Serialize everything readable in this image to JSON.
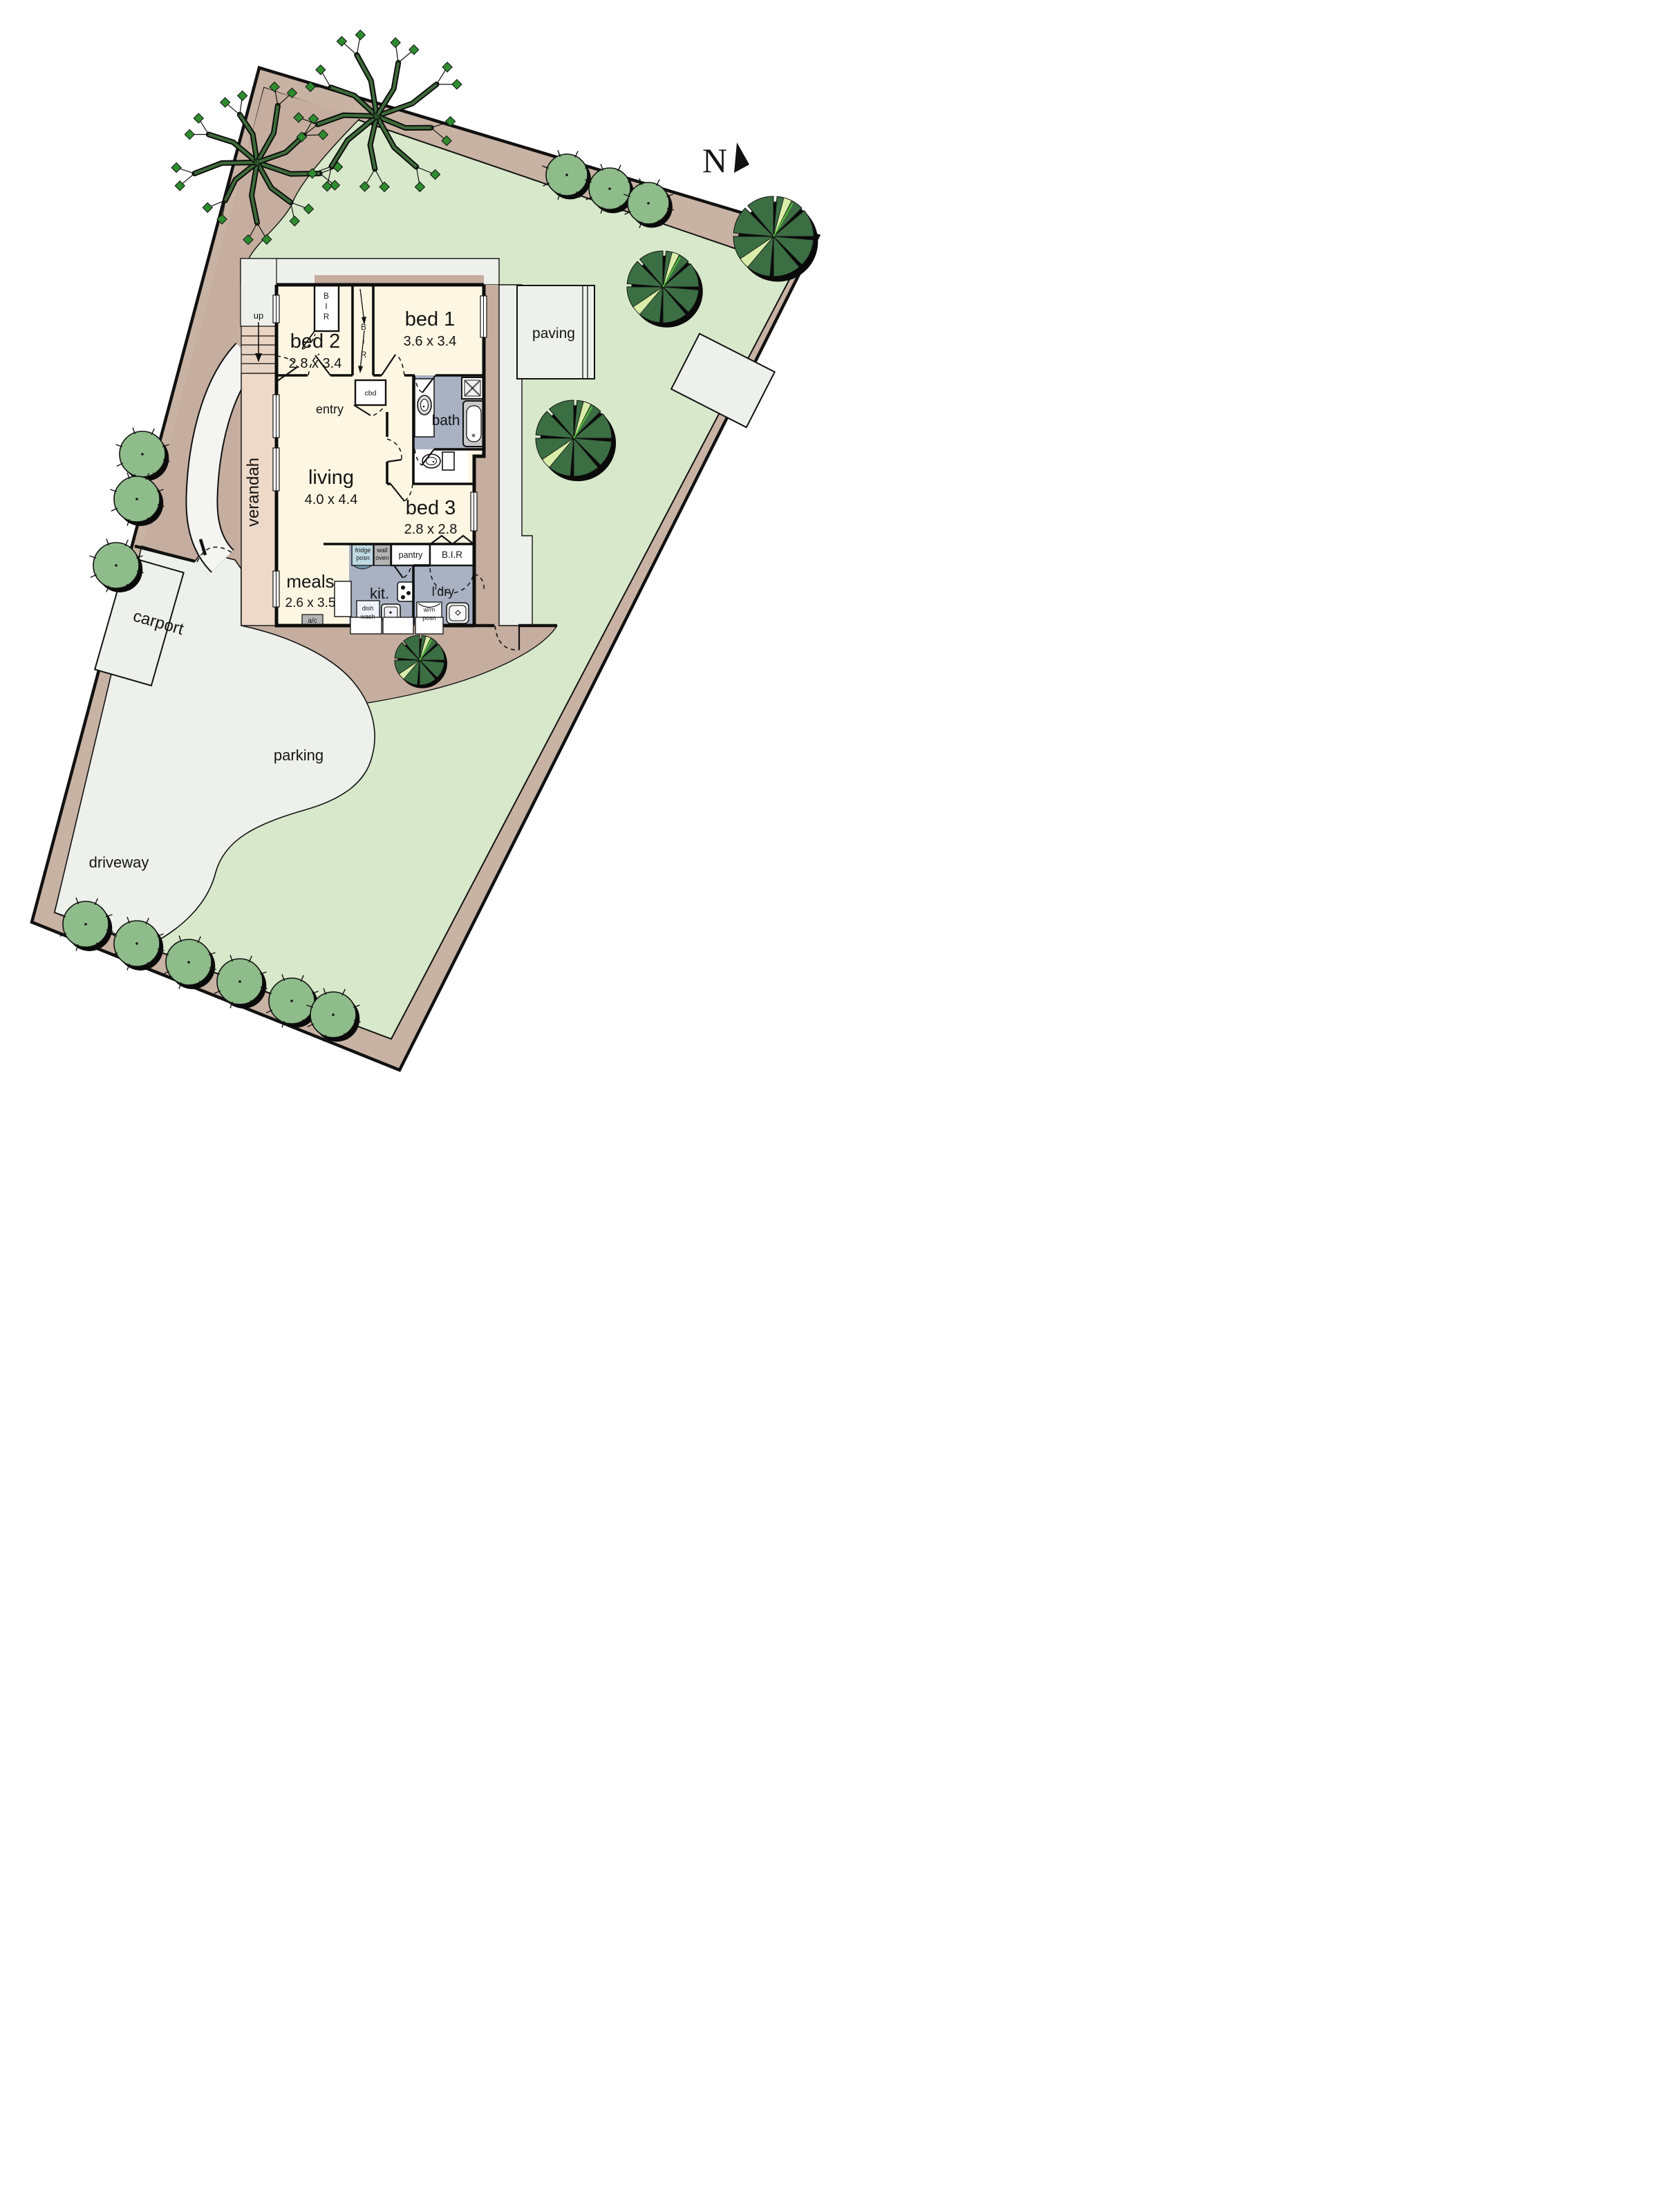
{
  "compass": {
    "north": "N"
  },
  "rooms": {
    "bed1": {
      "name": "bed 1",
      "dims": "3.6 x 3.4"
    },
    "bed2": {
      "name": "bed 2",
      "dims": "2.8 x 3.4"
    },
    "bed3": {
      "name": "bed 3",
      "dims": "2.8 x 2.8"
    },
    "living": {
      "name": "living",
      "dims": "4.0 x 4.4"
    },
    "meals": {
      "name": "meals",
      "dims": "2.6 x 3.5"
    },
    "entry": "entry",
    "bath": "bath",
    "kitchen": "kit.",
    "laundry": "l'dry",
    "pantry": "pantry",
    "bir": "B.I.R",
    "cbd": "cbd",
    "up": "up",
    "bir_vertical": [
      "B",
      "I",
      "R"
    ]
  },
  "site": {
    "verandah": "verandah",
    "paving": "paving",
    "carport": "carport",
    "parking": "parking",
    "driveway": "driveway"
  },
  "fixtures": {
    "fridge": [
      "fridge",
      "posn"
    ],
    "wall_oven": [
      "wall",
      "oven"
    ],
    "dish_wash": [
      "dish",
      "wash"
    ],
    "wm": [
      "w/m",
      "posn"
    ],
    "ac": "a/c"
  },
  "colors": {
    "band_tan": "#c8b2a3",
    "ground_brown": "#c5ae9f",
    "grass": "#d8e8cb",
    "hardscape": "#eef0ec",
    "room_cream": "#fdf6e2",
    "wet_floor": "#a9b1c3",
    "verandah_pink": "#eed9c8",
    "steps_tan": "#e9d4c3",
    "bushy_tree": "#8fbc8b",
    "dark_tree": "#3c6e44",
    "light_wedge": "#d9eda8",
    "fridge_blue": "#bed9e4",
    "appliance_grey": "#b4b4b4",
    "wall": "#0d0d0d"
  }
}
